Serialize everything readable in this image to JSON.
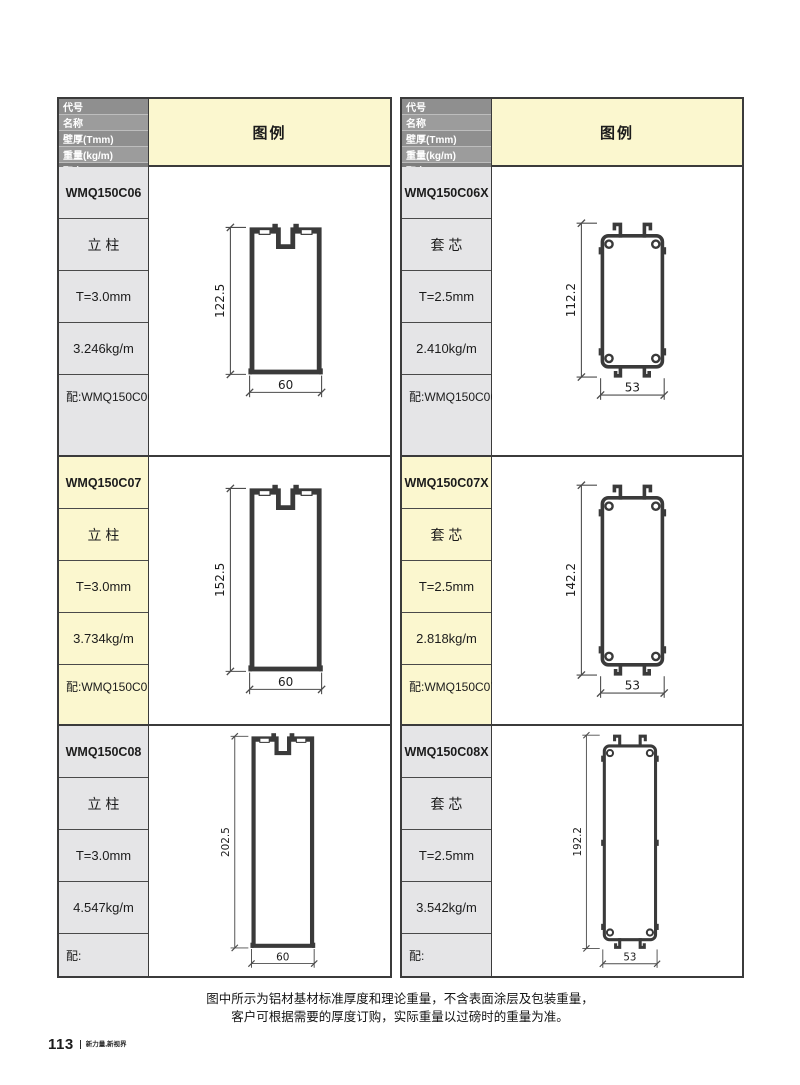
{
  "page": {
    "footer_note_line1": "图中所示为铝材基材标准厚度和理论重量，不含表面涂层及包装重量，",
    "footer_note_line2": "客户可根据需要的厚度订购，实际重量以过磅时的重量为准。",
    "page_number": "113",
    "page_brand": "新力量,新视界"
  },
  "table": {
    "header_labels": [
      "代号",
      "名称",
      "壁厚(Tmm)",
      "重量(kg/m)",
      "配套"
    ],
    "legend_label": "图例",
    "colors": {
      "highlight": "#FBF7CF",
      "cell_gray": "#E5E5E7",
      "header_dark": "#8F8F8F",
      "header_mid": "#9C9C9C",
      "header_last": "#7E7E7E",
      "line": "#3a3a3a"
    }
  },
  "profiles": [
    {
      "code": "WMQ150C06",
      "name": "立 柱",
      "thickness": "T=3.0mm",
      "weight": "3.246kg/m",
      "match": "配:WMQ150C06X",
      "highlight": false,
      "drawing": {
        "type": "mullion",
        "w": 60,
        "h": 122.5,
        "dim_h": "122.5",
        "dim_w": "60"
      }
    },
    {
      "code": "WMQ150C06X",
      "name": "套 芯",
      "thickness": "T=2.5mm",
      "weight": "2.410kg/m",
      "match": "配:WMQ150C06",
      "highlight": false,
      "drawing": {
        "type": "core",
        "w": 53,
        "h": 112.2,
        "dim_h": "112.2",
        "dim_w": "53"
      }
    },
    {
      "code": "WMQ150C07",
      "name": "立 柱",
      "thickness": "T=3.0mm",
      "weight": "3.734kg/m",
      "match": "配:WMQ150C07X",
      "highlight": true,
      "drawing": {
        "type": "mullion",
        "w": 60,
        "h": 152.5,
        "dim_h": "152.5",
        "dim_w": "60"
      }
    },
    {
      "code": "WMQ150C07X",
      "name": "套 芯",
      "thickness": "T=2.5mm",
      "weight": "2.818kg/m",
      "match": "配:WMQ150C07",
      "highlight": true,
      "drawing": {
        "type": "core",
        "w": 53,
        "h": 142.2,
        "dim_h": "142.2",
        "dim_w": "53"
      }
    },
    {
      "code": "WMQ150C08",
      "name": "立 柱",
      "thickness": "T=3.0mm",
      "weight": "4.547kg/m",
      "match": "配:",
      "highlight": false,
      "drawing": {
        "type": "mullion",
        "w": 60,
        "h": 202.5,
        "dim_h": "202.5",
        "dim_w": "60"
      }
    },
    {
      "code": "WMQ150C08X",
      "name": "套 芯",
      "thickness": "T=2.5mm",
      "weight": "3.542kg/m",
      "match": "配:",
      "highlight": false,
      "drawing": {
        "type": "core",
        "w": 53,
        "h": 192.2,
        "dim_h": "192.2",
        "dim_w": "53"
      }
    }
  ]
}
